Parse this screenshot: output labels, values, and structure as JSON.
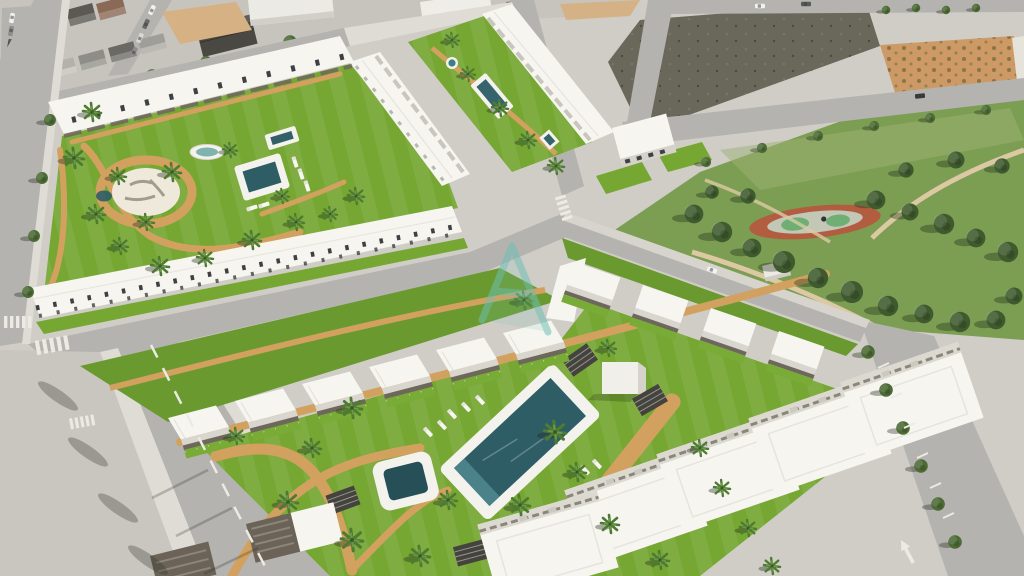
{
  "meta": {
    "type": "aerial-3d-architectural-render",
    "description": "Daytime aerial CGI visualization of a new-build Mediterranean residential development: white low-rise apartment blocks and terraced rows around communal lawns with swimming pools and palm trees, bordered by existing town blocks, vacant dirt plots, a tree-filled public park with an oval playground, and asphalt roads with parked cars."
  },
  "regions": {
    "old_town": "existing town blocks with parked cars (top-left)",
    "west_complex": "perimeter apartment block with round plaza, oval fountain and pool",
    "north_complex": "two terraced rows flanking a linear lawn with lap pool",
    "front_complex": "bungalow rows around a large lawn with main pool and kids pool",
    "park": "public park with pine trees and oval playground (right)",
    "vacant_lots": "unbuilt dark dirt plots (top-right)",
    "orange_field": "orange-earth plot with planted rows (top-right corner)"
  },
  "watermark": {
    "glyph": "A",
    "opacity": "0.55"
  },
  "colors": {
    "ground": "#cfcdc6",
    "road": "#b4b3af",
    "sidewalk": "#dedcd4",
    "apron": "#c8c6bf",
    "building_white": "#f6f5f0",
    "building_face": "#dcd9d1",
    "pergola": "#6e675c",
    "window": "#3e4143",
    "grass": "#76a733",
    "grass_band": "#6a9a2f",
    "park_green": "#7c9e52",
    "tree_green": "#3f5a2e",
    "palm_green": "#4e7b31",
    "path_tan": "#d2a15f",
    "park_path": "#dcc9a4",
    "pool_water": "#2e5d66",
    "pool_deck": "#f3f2ed",
    "dirt_dark": "#6a675b",
    "dirt_orange": "#cd9965",
    "playground_ring": "#b25c40",
    "playground_inner": "#c3c8b6",
    "playground_green": "#6fae74",
    "marking_white": "#eceae3",
    "watermark": "#6fbfb5",
    "car_red": "#a53c30"
  }
}
